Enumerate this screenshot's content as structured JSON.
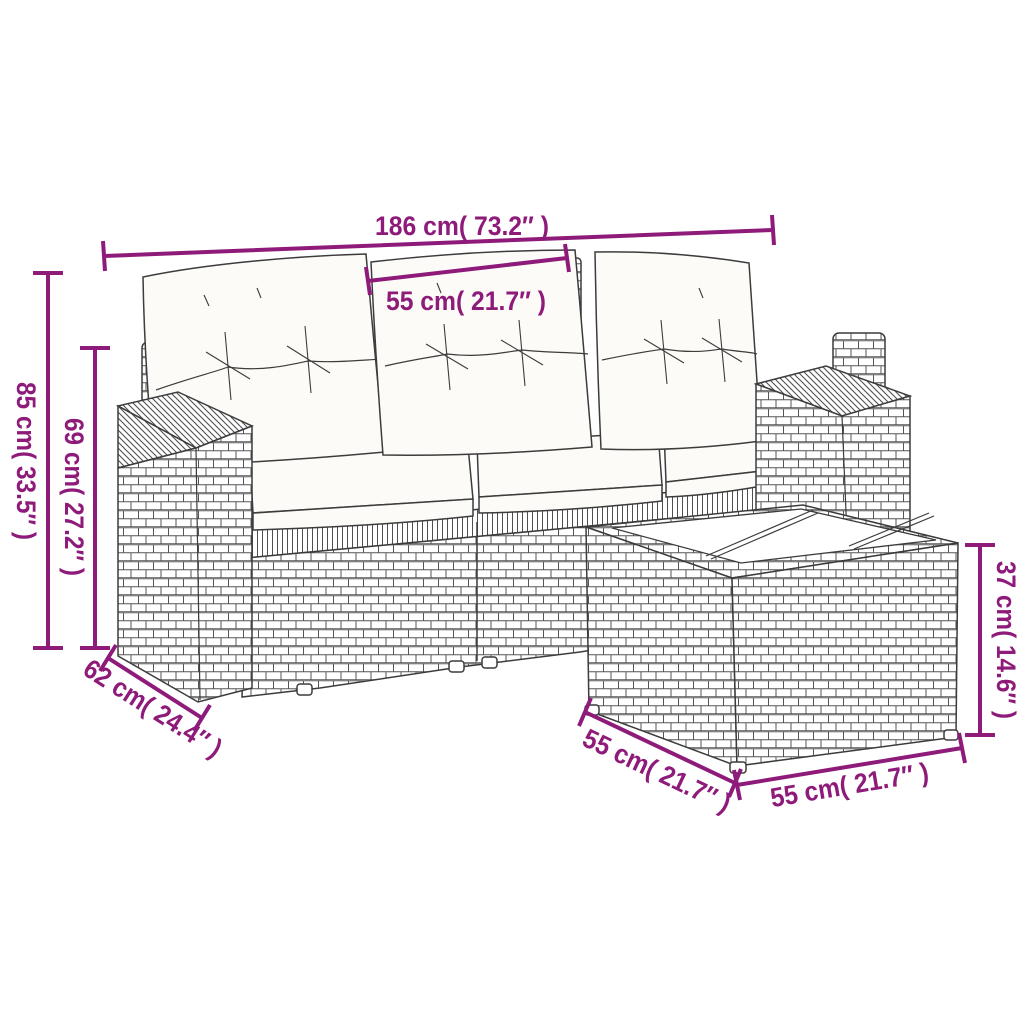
{
  "meta": {
    "type": "product-dimension-diagram",
    "subject": "poly-rattan garden sofa set with cushions and side table"
  },
  "style": {
    "accent_color": "#8E1A7A",
    "drawing_color": "#3C3C3C",
    "background": "#FFFFFF"
  },
  "dimensions": {
    "sofa_total_width": {
      "label": "186 cm( 73.2″ )"
    },
    "seat_module_width": {
      "label": "55 cm( 21.7″ )"
    },
    "sofa_total_height": {
      "label": "85 cm( 33.5″ )"
    },
    "backrest_height": {
      "label": "69 cm( 27.2″ )"
    },
    "sofa_depth": {
      "label": "62 cm( 24.4″ )"
    },
    "table_depth": {
      "label": "55 cm( 21.7″ )"
    },
    "table_width": {
      "label": "55 cm( 21.7″ )"
    },
    "table_height": {
      "label": "37 cm( 14.6″ )"
    }
  }
}
